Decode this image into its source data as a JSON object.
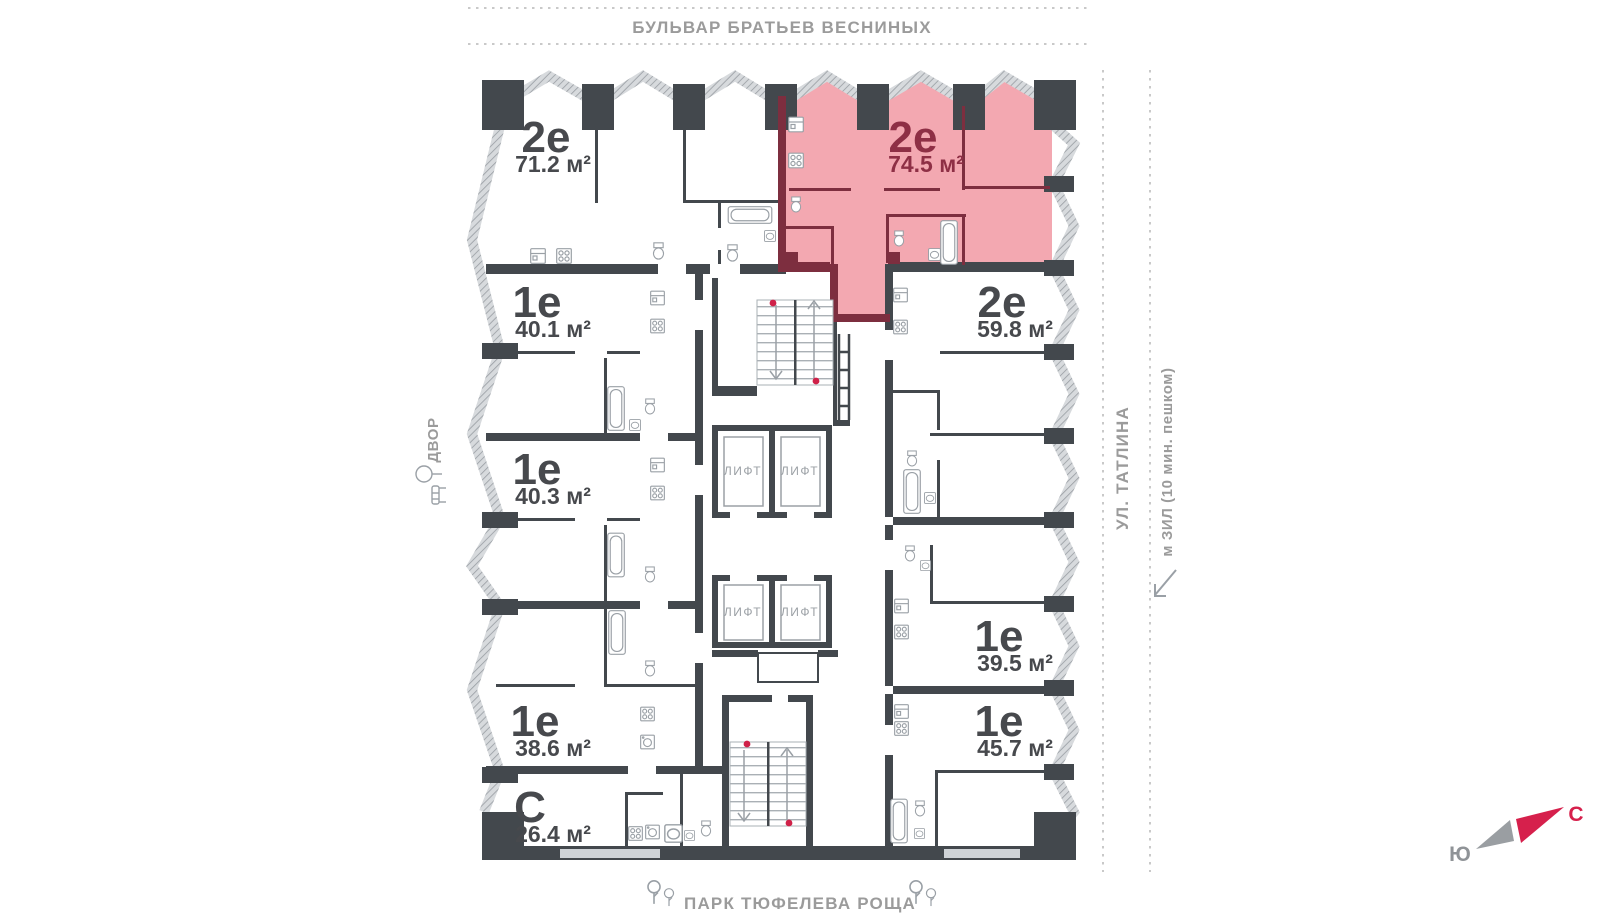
{
  "plan": {
    "street_top": "БУЛЬВАР БРАТЬЕВ ВЕСНИНЫХ",
    "street_bottom": "ПАРК ТЮФЕЛЕВА РОЩА",
    "side_left": "ДВОР",
    "side_right_street": "УЛ. ТАТЛИНА",
    "side_right_metro": "м ЗИЛ (10 мин. пешком)",
    "elevator": "ЛИФТ",
    "compass": {
      "north": "С",
      "south": "Ю"
    },
    "apartments": [
      {
        "type": "2е",
        "area": "71.2 м²",
        "highlighted": false
      },
      {
        "type": "2е",
        "area": "74.5 м²",
        "highlighted": true
      },
      {
        "type": "1е",
        "area": "40.1 м²",
        "highlighted": false
      },
      {
        "type": "2е",
        "area": "59.8 м²",
        "highlighted": false
      },
      {
        "type": "1е",
        "area": "40.3 м²",
        "highlighted": false
      },
      {
        "type": "1е",
        "area": "39.5 м²",
        "highlighted": false
      },
      {
        "type": "1е",
        "area": "38.6 м²",
        "highlighted": false
      },
      {
        "type": "1е",
        "area": "45.7 м²",
        "highlighted": false
      },
      {
        "type": "С",
        "area": "26.4 м²",
        "highlighted": false
      }
    ],
    "colors": {
      "highlight_fill": "#f3a8b1",
      "highlight_wall": "#7d2e3f",
      "wall": "#43484d",
      "accent_red": "#d6204c",
      "muted_text": "#9b9fa3"
    }
  }
}
